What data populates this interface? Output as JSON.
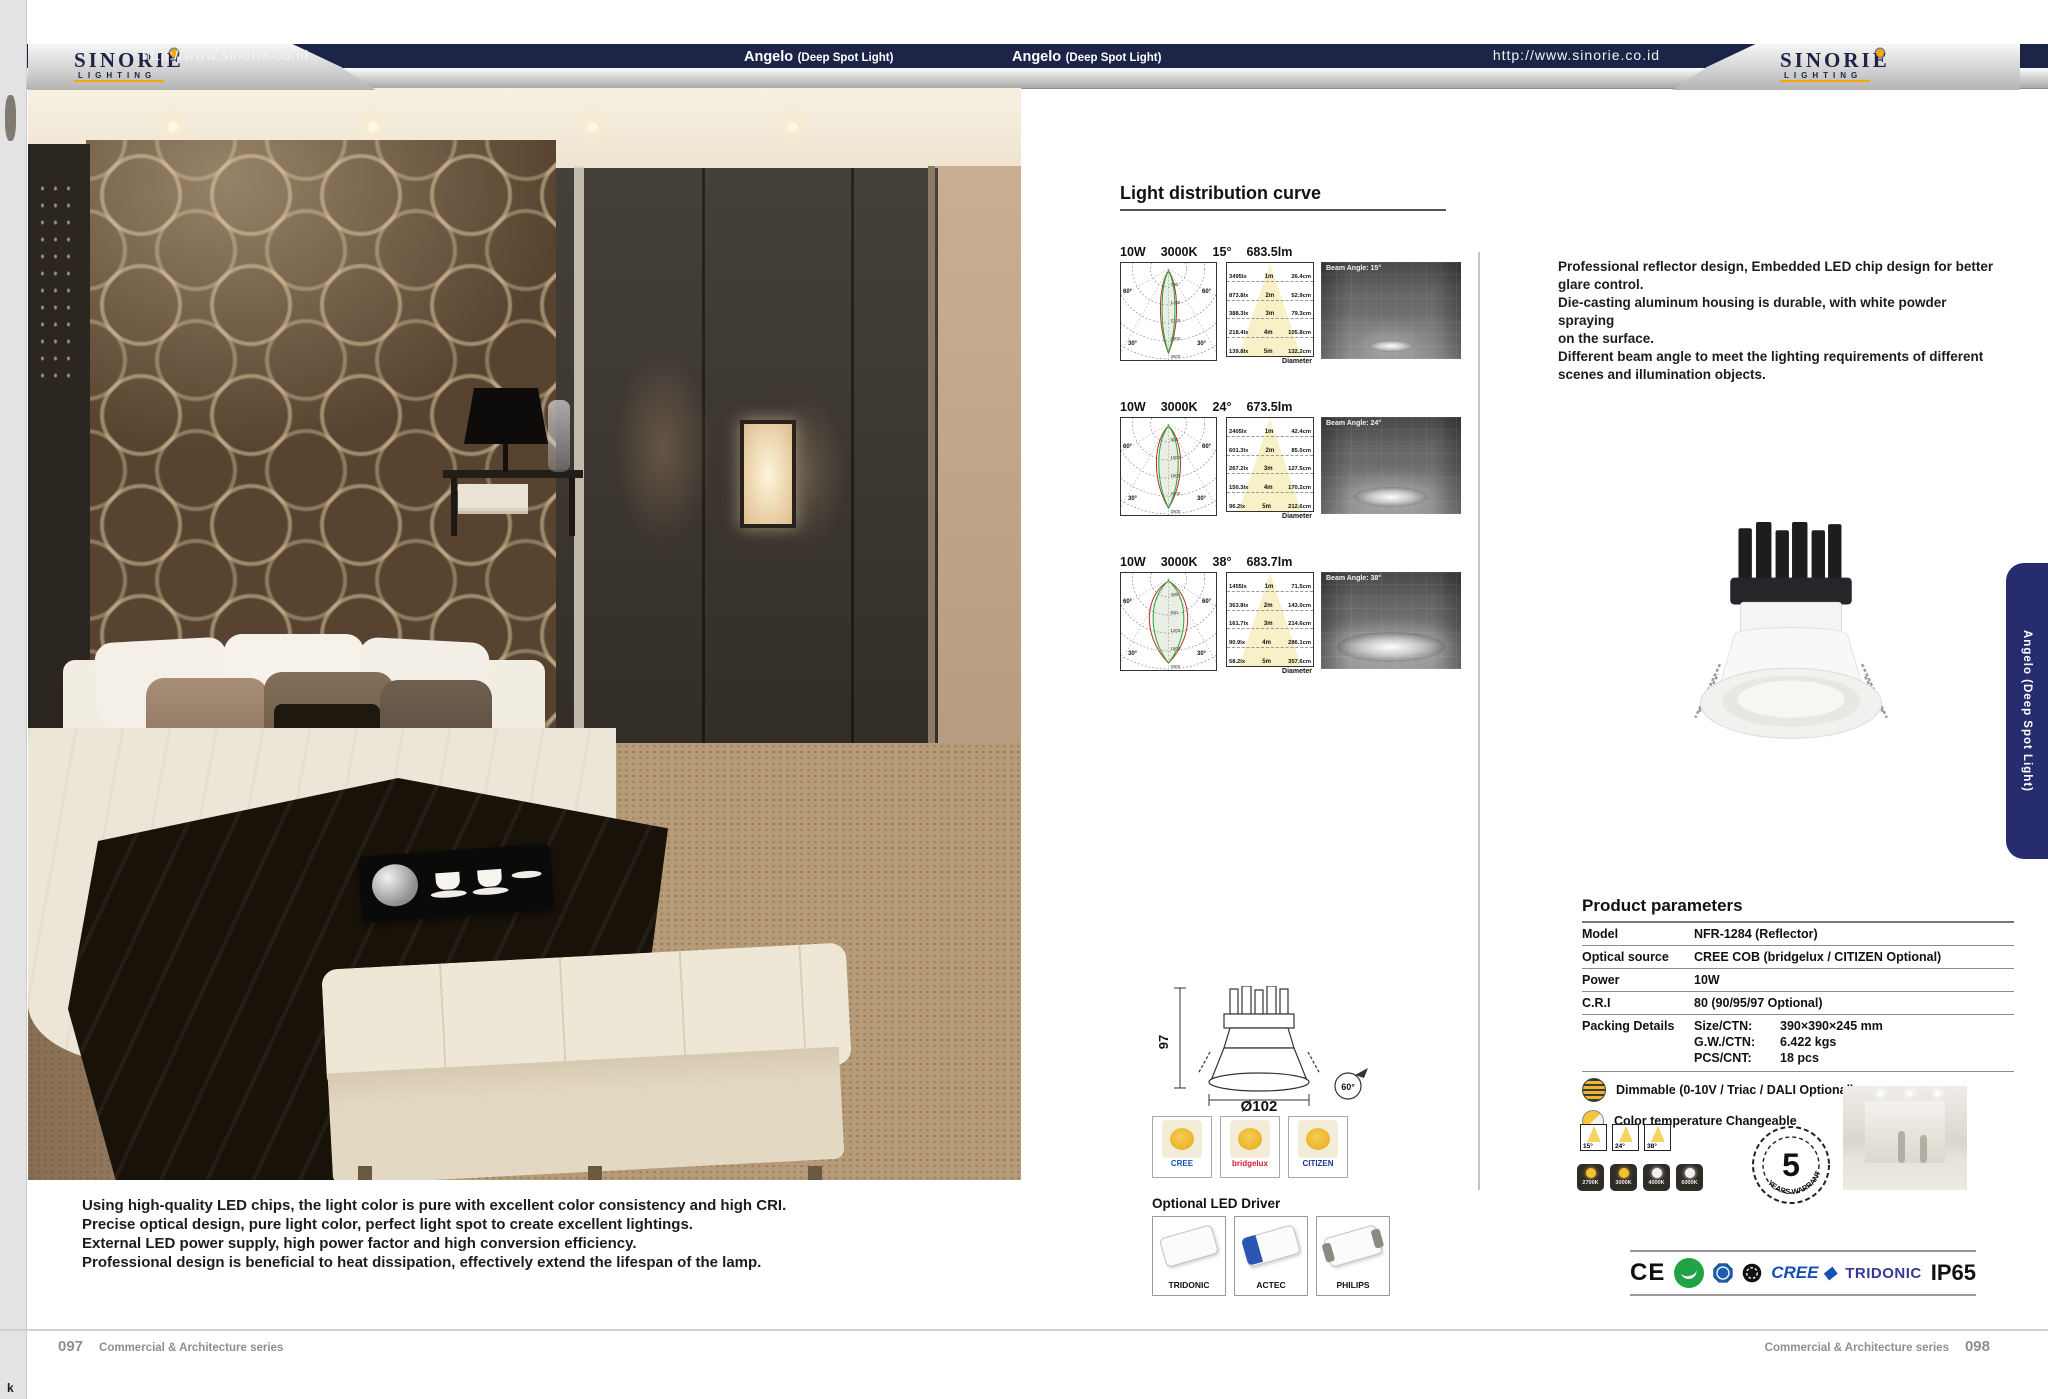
{
  "header": {
    "url": "http://www.sinorie.co.id",
    "product_title": "Angelo",
    "product_subtitle": "(Deep Spot Light)",
    "brand": "SINORIE",
    "brand_tagline": "LIGHTING"
  },
  "left_page": {
    "description_lines": [
      "Using high-quality LED chips, the light color is pure with excellent color consistency and high CRI.",
      "Precise optical design, pure light color, perfect light spot to create excellent lightings.",
      "External LED power supply, high power factor and high conversion efficiency.",
      "Professional design is beneficial to heat dissipation, effectively extend the lifespan of the lamp."
    ],
    "page_number": "097",
    "series": "Commercial & Architecture series",
    "corner_mark": "k"
  },
  "light_distribution": {
    "title": "Light distribution curve",
    "polar_angles": [
      "60°",
      "30°"
    ],
    "rows": [
      {
        "power": "10W",
        "cct": "3000K",
        "angle": "15°",
        "flux": "683.5lm",
        "beam_label": "Beam Angle: 15°",
        "polar_scale": [
          "700",
          "1400",
          "2100",
          "2800",
          "3500"
        ],
        "cone_rows": [
          [
            "3495lx",
            "1m",
            "26.4cm"
          ],
          [
            "873.8lx",
            "2m",
            "52.9cm"
          ],
          [
            "388.3lx",
            "3m",
            "79.3cm"
          ],
          [
            "218.4lx",
            "4m",
            "105.8cm"
          ],
          [
            "139.8lx",
            "5m",
            "132.2cm"
          ]
        ],
        "diameter_label": "Diameter"
      },
      {
        "power": "10W",
        "cct": "3000K",
        "angle": "24°",
        "flux": "673.5lm",
        "beam_label": "Beam Angle: 24°",
        "polar_scale": [
          "500",
          "1000",
          "1500",
          "2000",
          "2500"
        ],
        "cone_rows": [
          [
            "2405lx",
            "1m",
            "42.4cm"
          ],
          [
            "601.3lx",
            "2m",
            "85.0cm"
          ],
          [
            "267.2lx",
            "3m",
            "127.5cm"
          ],
          [
            "150.3lx",
            "4m",
            "170.2cm"
          ],
          [
            "96.2lx",
            "5m",
            "212.6cm"
          ]
        ],
        "diameter_label": "Diameter"
      },
      {
        "power": "10W",
        "cct": "3000K",
        "angle": "38°",
        "flux": "683.7lm",
        "beam_label": "Beam Angle: 38°",
        "polar_scale": [
          "400",
          "800",
          "1200",
          "1600",
          "2000"
        ],
        "cone_rows": [
          [
            "1455lx",
            "1m",
            "71.5cm"
          ],
          [
            "363.8lx",
            "2m",
            "143.0cm"
          ],
          [
            "161.7lx",
            "3m",
            "214.6cm"
          ],
          [
            "90.9lx",
            "4m",
            "286.1cm"
          ],
          [
            "58.2lx",
            "5m",
            "357.6cm"
          ]
        ],
        "diameter_label": "Diameter"
      }
    ]
  },
  "right_page": {
    "intro_lines": [
      "Professional reflector design, Embedded LED chip design for better",
      "glare control.",
      "Die-casting aluminum housing is durable, with white powder spraying",
      "on the surface.",
      "Different beam angle to meet the lighting requirements of different",
      "scenes and illumination objects."
    ],
    "tab_label": "Angelo (Deep Spot Light)",
    "page_number": "098",
    "series": "Commercial & Architecture series"
  },
  "product_parameters": {
    "title": "Product parameters",
    "rows": [
      {
        "label": "Model",
        "value": "NFR-1284  (Reflector)"
      },
      {
        "label": "Optical source",
        "value": "CREE COB (bridgelux / CITIZEN Optional)"
      },
      {
        "label": "Power",
        "value": "10W"
      },
      {
        "label": "C.R.I",
        "value": "80 (90/95/97 Optional)"
      }
    ],
    "packing": {
      "label": "Packing Details",
      "lines": [
        {
          "k": "Size/CTN:",
          "v": "390×390×245 mm"
        },
        {
          "k": "G.W./CTN:",
          "v": "6.422 kgs"
        },
        {
          "k": "PCS/CNT:",
          "v": "18 pcs"
        }
      ]
    },
    "dimmable": "Dimmable (0-10V / Triac / DALI Optional)",
    "cct_changeable": "Color temperature Changeable",
    "beam_options": [
      "15°",
      "24°",
      "38°"
    ],
    "cct_options": [
      "2700K",
      "3000K",
      "4000K",
      "6000K"
    ],
    "warranty": {
      "number": "5",
      "text": "YEARS WARRANTY"
    }
  },
  "dimensions": {
    "height": "97",
    "diameter": "Ø102",
    "tilt": "60°"
  },
  "chips": [
    {
      "name": "CREE",
      "color": "#1550b4"
    },
    {
      "name": "bridgelux",
      "color": "#cf2030"
    },
    {
      "name": "CITIZEN",
      "color": "#173a8f"
    }
  ],
  "drivers": {
    "title": "Optional LED Driver",
    "brands": [
      "TRIDONIC",
      "ACTEC",
      "PHILIPS"
    ]
  },
  "certifications": {
    "ce": "CE",
    "cree": "CREE ◆",
    "tridonic": "TRIDONIC",
    "ip": "IP65"
  },
  "colors": {
    "navy": "#1c2547",
    "accent_yellow": "#f5a800",
    "tab_blue": "#272c6e"
  }
}
